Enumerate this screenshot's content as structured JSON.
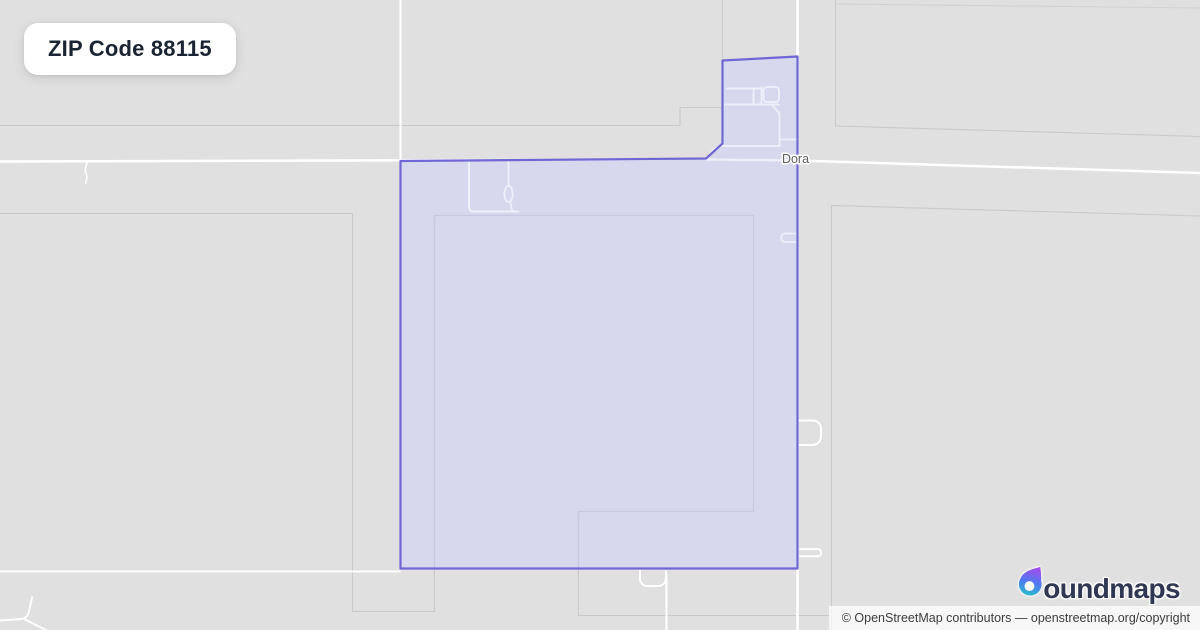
{
  "title_badge": {
    "label": "ZIP Code 88115"
  },
  "map": {
    "place_label": "Dora",
    "boundary_name": "ZIP 88115 boundary polygon"
  },
  "branding": {
    "name": "boundmaps",
    "wordmark_suffix": "oundmaps"
  },
  "attribution": {
    "text": "© OpenStreetMap contributors — openstreetmap.org/copyright"
  },
  "colors": {
    "background": "#e0e0e0",
    "road": "#ffffff",
    "parcel_line": "#c9c9c9",
    "parcel_line_tinted": "#c6c9e2",
    "road_tinted": "#eef0f9",
    "boundary_stroke": "#6f67d5",
    "boundary_fill": "#d6d9ee",
    "place_label": "#5f5f5f",
    "title_text": "#1a2433",
    "brand_text": "#2f3753",
    "attribution_text": "#3c3c3c",
    "attribution_bg": "rgba(255,255,255,0.72)",
    "badge_bg": "#ffffff",
    "drop_top": "#9d4fed",
    "drop_mid": "#4d7bf0",
    "drop_bottom": "#27c3cb"
  }
}
